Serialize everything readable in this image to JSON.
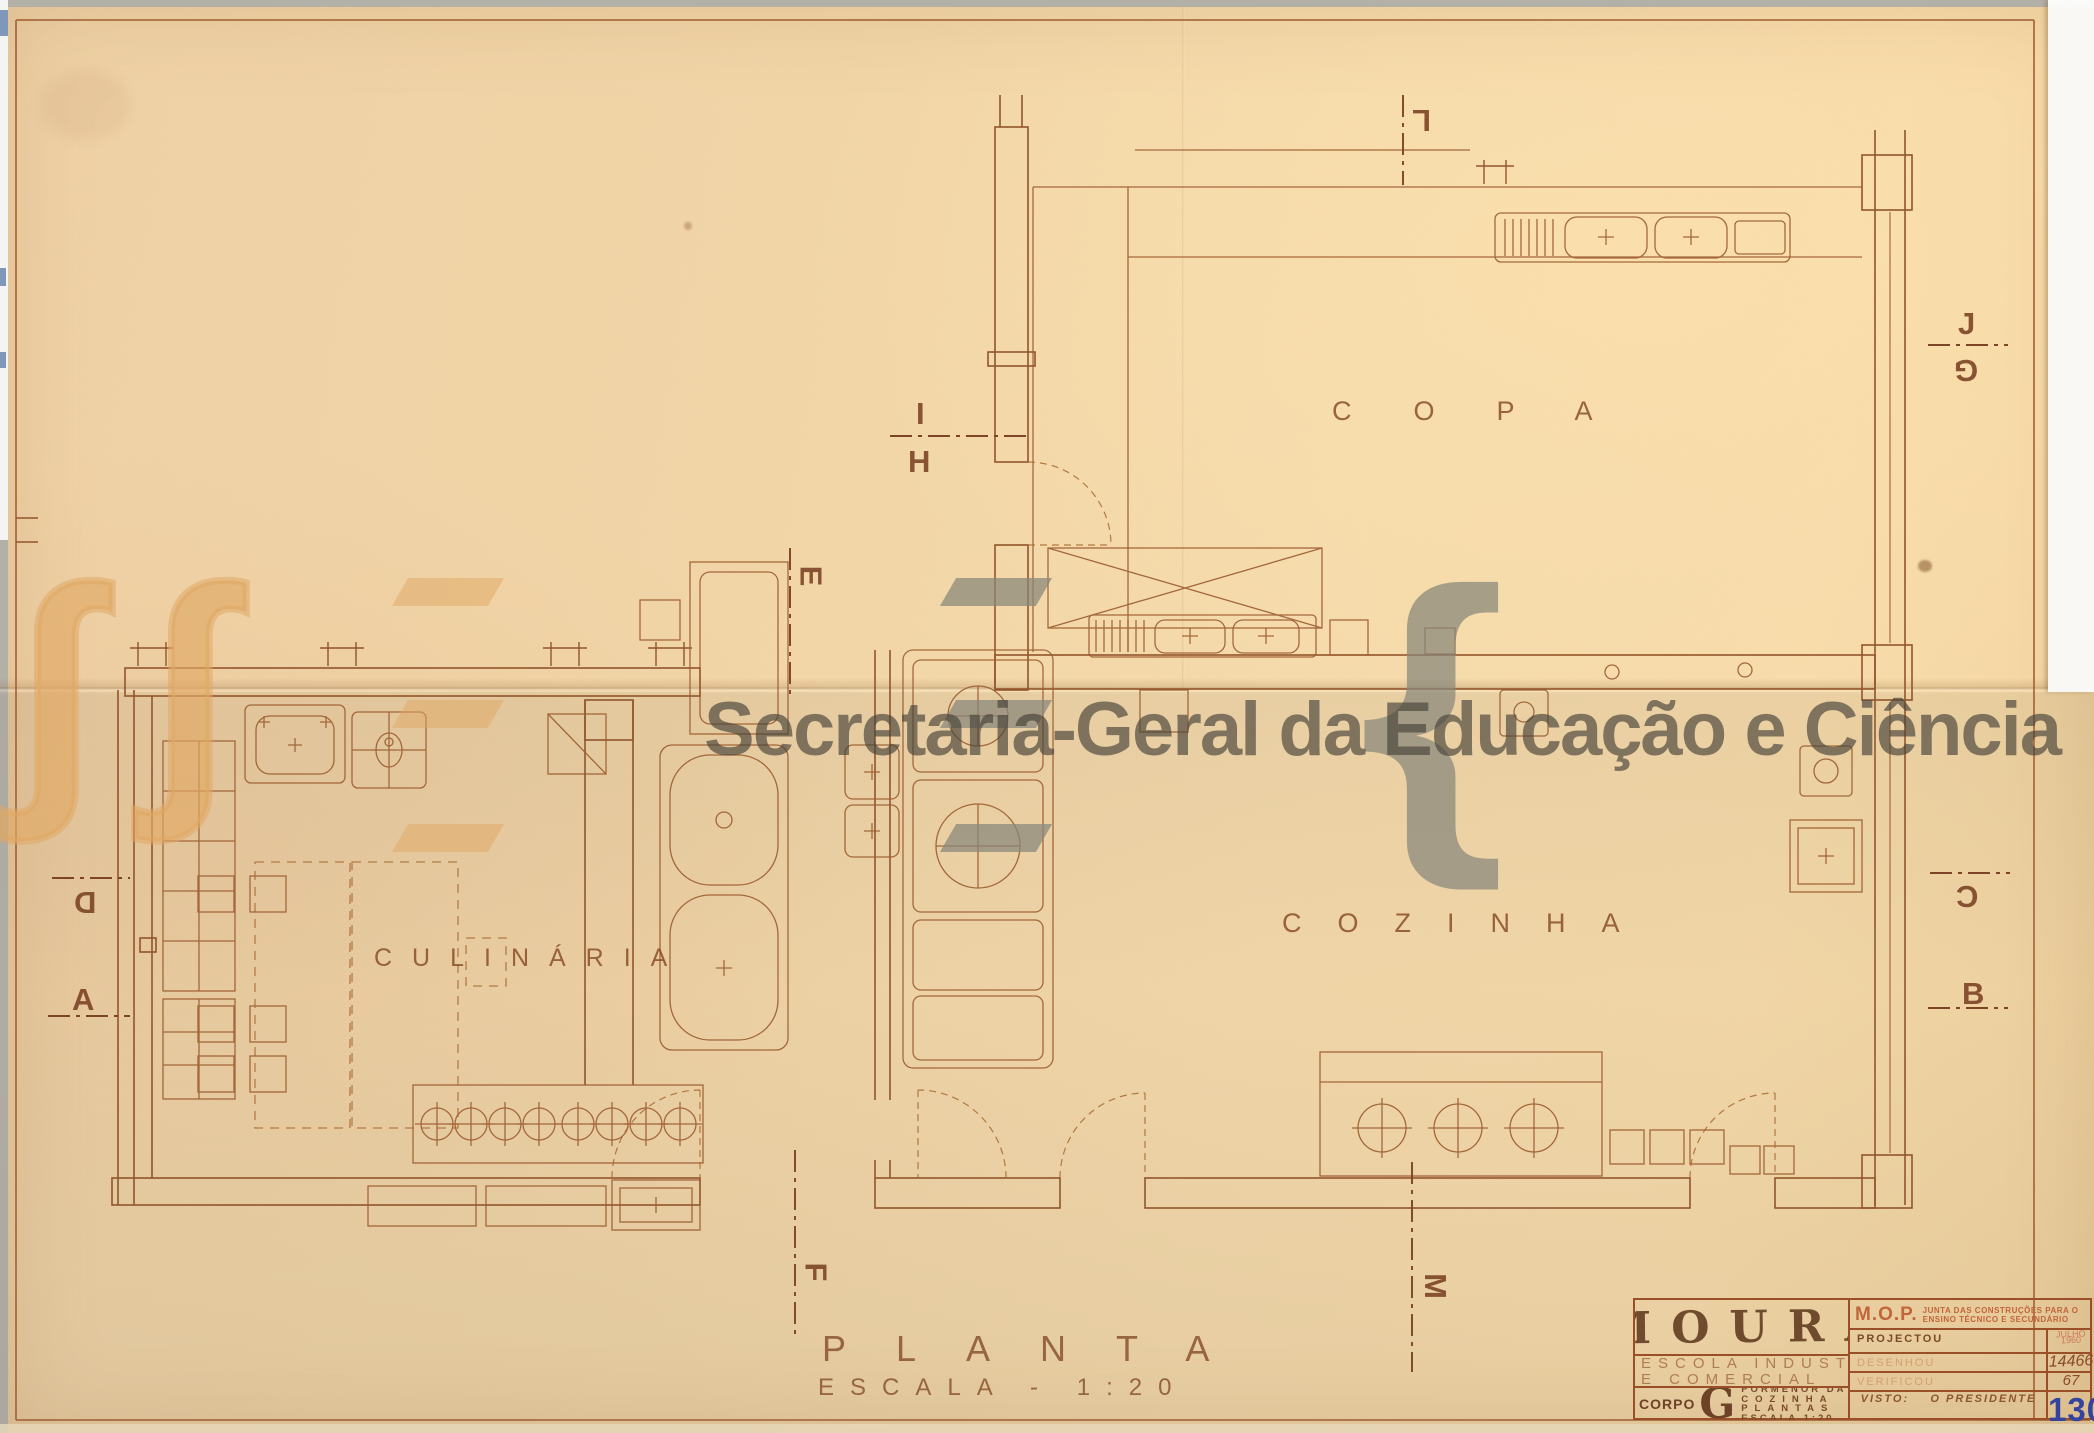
{
  "watermark": {
    "text": "Secretaria-Geral da Educação e Ciência",
    "color": "#484339",
    "logo": {
      "stroke_glyph": "integral-curve",
      "bars_glyph": "triple-parallelogram",
      "brace_glyph": "{"
    }
  },
  "rooms": {
    "copa": "COPA",
    "cozinha": "COZINHA",
    "culinaria": "CULINÁRIA"
  },
  "plan_title": {
    "title": "PLANTA",
    "scale": "ESCALA - 1:20"
  },
  "markers": {
    "l": "L",
    "i": "I",
    "h": "H",
    "e": "E",
    "j": "J",
    "g": "G",
    "d": "D",
    "a": "A",
    "c": "C",
    "b": "B",
    "f": "F",
    "m": "M"
  },
  "title_block": {
    "stamp": "MOURA",
    "school_line1": "ESCOLA INDUSTRIAL",
    "school_line2": "E COMERCIAL",
    "corpo_label": "CORPO",
    "corpo_letter": "G",
    "corpo_lines": [
      "PORMENOR DA",
      "COZINHA",
      "PLANTAS",
      "ESCALA 1:20"
    ],
    "org": "M.O.P.",
    "org_sub1": "JUNTA DAS CONSTRUÇÕES PARA O",
    "org_sub2": "ENSINO TÉCNICO E SECUNDÁRIO",
    "row_projectou": "PROJECTOU",
    "row_desenhou": "DESENHOU",
    "row_verificou": "VERIFICOU",
    "visto_label": "VISTO:",
    "visto_value": "O PRESIDENTE",
    "date_month": "JULHO",
    "date_year": "1960",
    "num_process": "14466",
    "num_aux": "67",
    "sheet_number": "130",
    "accent_blue": "#33449e",
    "accent_red": "#c2653a"
  }
}
